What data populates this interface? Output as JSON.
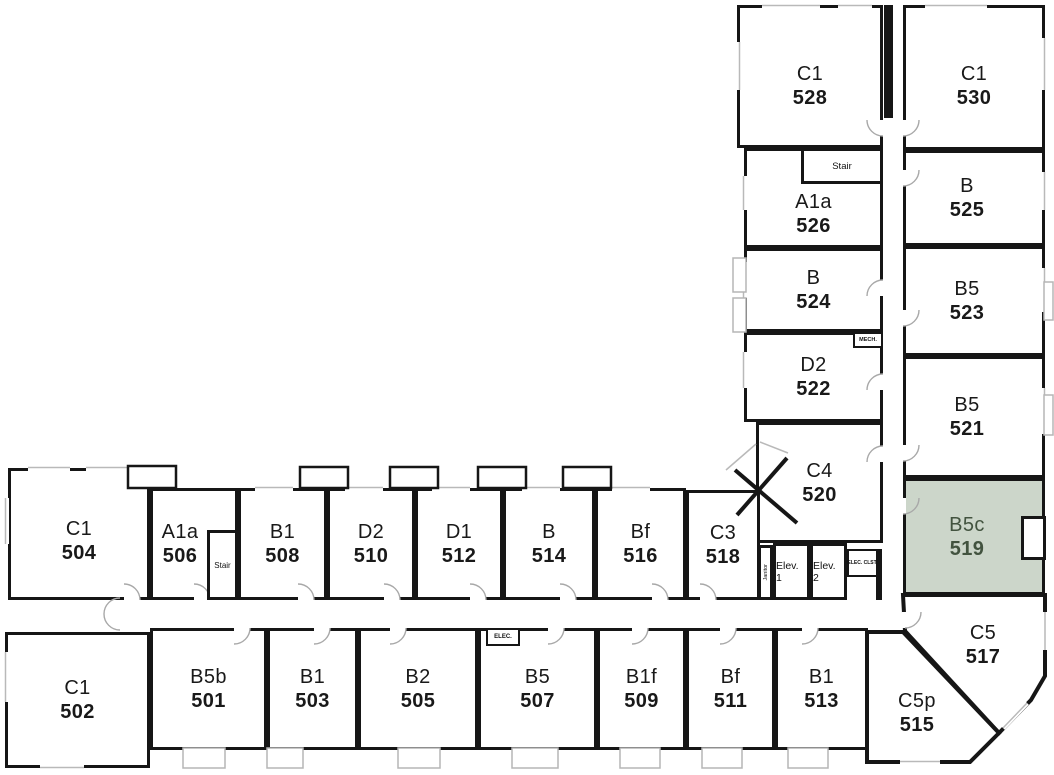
{
  "plan": {
    "highlighted_unit": "519",
    "highlight_fill": "#ccd6ca",
    "highlight_text": "#42533f",
    "wall_color": "#161616"
  },
  "rooms": [
    {
      "type": "C1",
      "number": "528"
    },
    {
      "type": "C1",
      "number": "530"
    },
    {
      "type": "A1a",
      "number": "526"
    },
    {
      "type": "B",
      "number": "525"
    },
    {
      "type": "B",
      "number": "524"
    },
    {
      "type": "B5",
      "number": "523"
    },
    {
      "type": "D2",
      "number": "522"
    },
    {
      "type": "B5",
      "number": "521"
    },
    {
      "type": "C4",
      "number": "520"
    },
    {
      "type": "B5c",
      "number": "519",
      "highlighted": true
    },
    {
      "type": "C5",
      "number": "517"
    },
    {
      "type": "C5p",
      "number": "515"
    },
    {
      "type": "C1",
      "number": "504"
    },
    {
      "type": "A1a",
      "number": "506"
    },
    {
      "type": "B1",
      "number": "508"
    },
    {
      "type": "D2",
      "number": "510"
    },
    {
      "type": "D1",
      "number": "512"
    },
    {
      "type": "B",
      "number": "514"
    },
    {
      "type": "Bf",
      "number": "516"
    },
    {
      "type": "C3",
      "number": "518"
    },
    {
      "type": "C1",
      "number": "502"
    },
    {
      "type": "B5b",
      "number": "501"
    },
    {
      "type": "B1",
      "number": "503"
    },
    {
      "type": "B2",
      "number": "505"
    },
    {
      "type": "B5",
      "number": "507"
    },
    {
      "type": "B1f",
      "number": "509"
    },
    {
      "type": "Bf",
      "number": "511"
    },
    {
      "type": "B1",
      "number": "513"
    }
  ],
  "service": {
    "stair_upper": "Stair",
    "stair_lower": "Stair",
    "mech": "MECH.",
    "elev1": "Elev. 1",
    "elev2": "Elev. 2",
    "elec_closet": "ELEC. CLST.",
    "janitor": "Janitor",
    "elec": "ELEC."
  }
}
